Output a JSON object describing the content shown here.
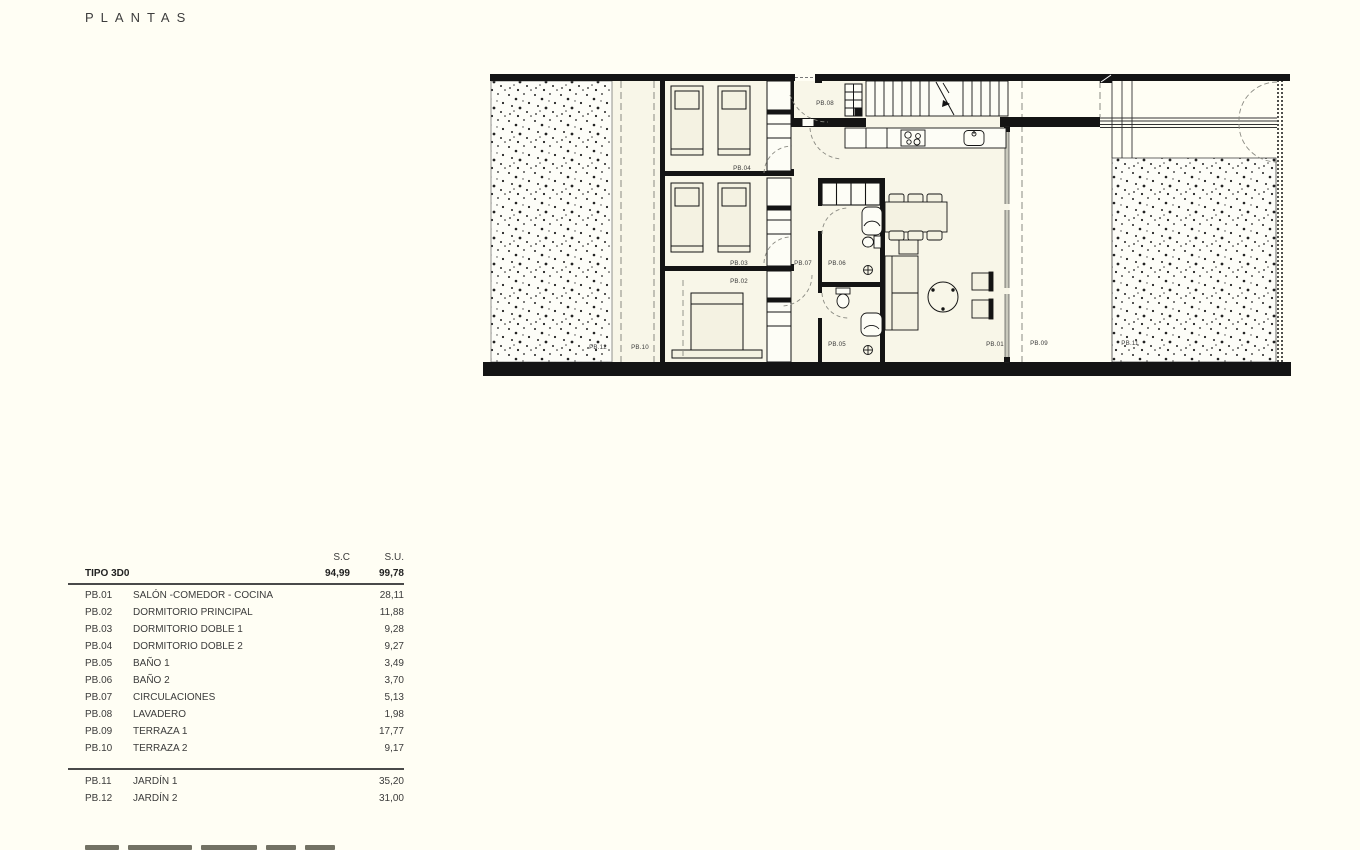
{
  "page": {
    "title": "PLANTAS"
  },
  "plan": {
    "labels": {
      "pb01": "PB.01",
      "pb02": "PB.02",
      "pb03": "PB.03",
      "pb04": "PB.04",
      "pb05": "PB.05",
      "pb06": "PB.06",
      "pb07": "PB.07",
      "pb08": "PB.08",
      "pb09": "PB.09",
      "pb10": "PB.10",
      "pb11": "PB.11",
      "pb12": "PB.12"
    }
  },
  "table": {
    "col_sc": "S.C",
    "col_su": "S.U.",
    "type_row": {
      "label": "TIPO 3D0",
      "sc": "94,99",
      "su": "99,78"
    },
    "rows": [
      {
        "code": "PB.01",
        "name": "SALÓN -COMEDOR - COCINA",
        "su": "28,11"
      },
      {
        "code": "PB.02",
        "name": "DORMITORIO PRINCIPAL",
        "su": "11,88"
      },
      {
        "code": "PB.03",
        "name": "DORMITORIO DOBLE 1",
        "su": "9,28"
      },
      {
        "code": "PB.04",
        "name": "DORMITORIO DOBLE 2",
        "su": "9,27"
      },
      {
        "code": "PB.05",
        "name": "BAÑO 1",
        "su": "3,49"
      },
      {
        "code": "PB.06",
        "name": "BAÑO 2",
        "su": "3,70"
      },
      {
        "code": "PB.07",
        "name": "CIRCULACIONES",
        "su": "5,13"
      },
      {
        "code": "PB.08",
        "name": "LAVADERO",
        "su": "1,98"
      },
      {
        "code": "PB.09",
        "name": "TERRAZA 1",
        "su": "17,77"
      },
      {
        "code": "PB.10",
        "name": "TERRAZA 2",
        "su": "9,17"
      }
    ],
    "outdoor_rows": [
      {
        "code": "PB.11",
        "name": "JARDÍN 1",
        "su": "35,20"
      },
      {
        "code": "PB.12",
        "name": "JARDÍN 2",
        "su": "31,00"
      }
    ]
  },
  "colors": {
    "wall": "#141414",
    "paper": "#FFFEF4",
    "room_fill": "#F8F6E8",
    "dash": "#8a8a82"
  }
}
